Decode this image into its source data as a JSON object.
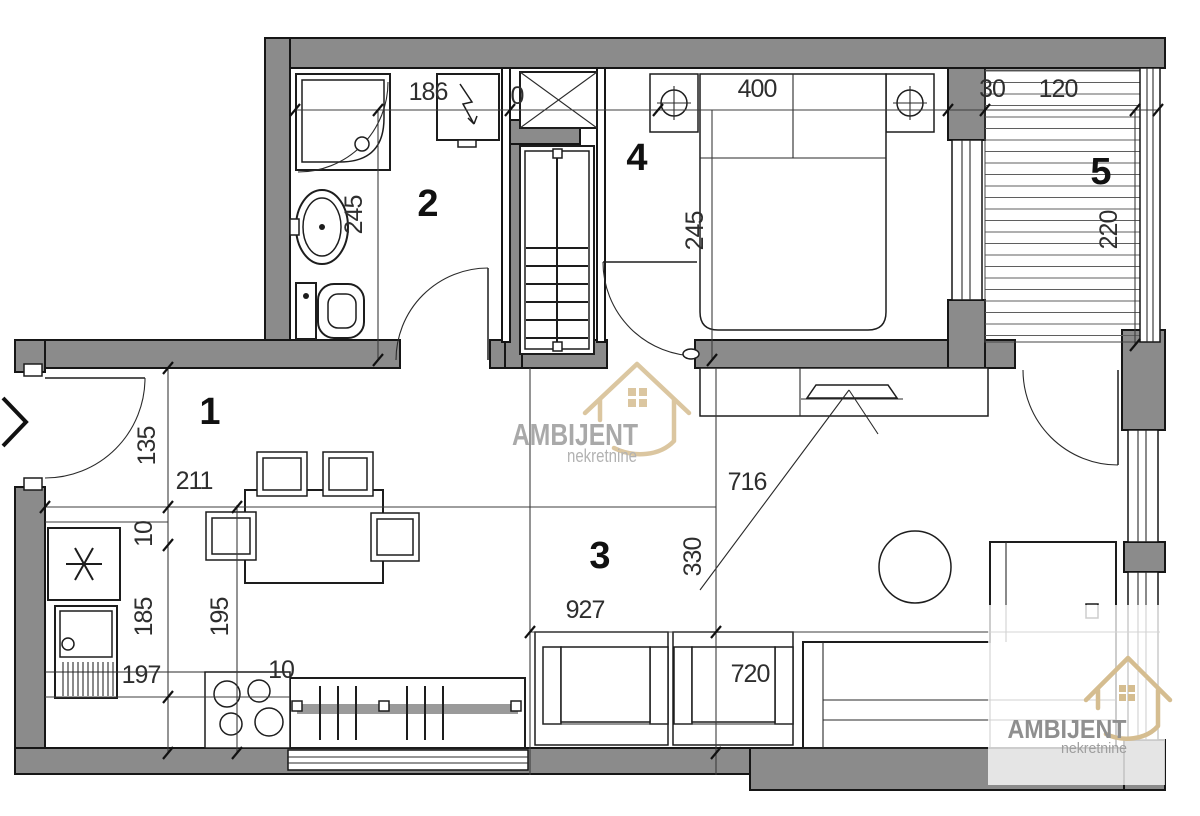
{
  "title": "Apartment floor plan",
  "brand": {
    "name": "AMBIJENT",
    "subtitle": "nekretnine"
  },
  "colors": {
    "wall_fill": "#8b8b8b",
    "line": "#1d1d1d",
    "dimension_text": "#2e2e2e",
    "logo_gold": "#d5bd90",
    "logo_gray": "#9b9b9b",
    "badge_overlay": "rgba(255,255,255,0.78)"
  },
  "rooms": {
    "r1": "1",
    "r2": "2",
    "r3": "3",
    "r4": "4",
    "r5": "5"
  },
  "dims": {
    "bath_width": "186",
    "bed_width": "400",
    "gap": "30",
    "terrace_width": "120",
    "zero": "0",
    "bath_depth": "245",
    "bed_depth": "245",
    "terrace_depth": "220",
    "hall_door": "135",
    "hall_width": "211",
    "wall_thin": "10",
    "kitchen_depth": "185",
    "kitchen_width": "195",
    "kitchen_len": "197",
    "stove_off": "10",
    "living_len": "927",
    "living_depth": "330",
    "living_width": "716",
    "sofa_wall": "720"
  }
}
